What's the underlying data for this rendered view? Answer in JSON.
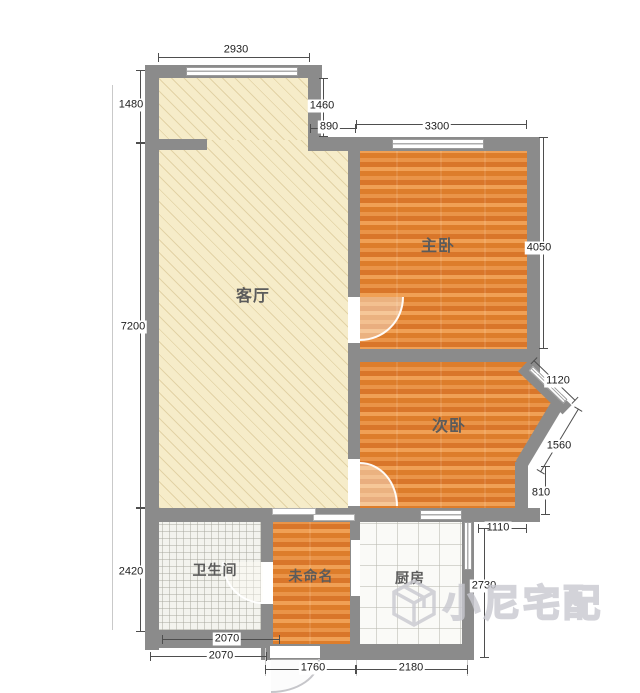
{
  "plan": {
    "rooms": {
      "living": {
        "label": "客厅"
      },
      "master": {
        "label": "主卧"
      },
      "second": {
        "label": "次卧"
      },
      "bathroom": {
        "label": "卫生间"
      },
      "unnamed": {
        "label": "未命名"
      },
      "kitchen": {
        "label": "厨房"
      }
    },
    "dimensions": {
      "living_top_width": "2930",
      "living_left_upper": "1480",
      "living_left_height": "7200",
      "bathroom_left_height": "2420",
      "step_right_height": "1460",
      "step_width": "890",
      "master_top_width": "3300",
      "master_right_height": "4050",
      "bay_upper_width": "1120",
      "bay_lower_width": "1560",
      "bay_right_height": "810",
      "nook_top_width": "1110",
      "kitchen_right_height": "2730",
      "bathroom_inner_width": "2070",
      "bathroom_outer_width": "2070",
      "entry_bottom_width": "1760",
      "kitchen_bottom_width": "2180"
    },
    "watermark": {
      "text": "小尼宅配"
    },
    "colors": {
      "wall": "#8b8b8b",
      "wood_floor": "#e5893a",
      "living_floor": "#f6ecc9",
      "bath_tile": "#f3f3ee",
      "kitchen_tile": "#fafaf7"
    }
  }
}
